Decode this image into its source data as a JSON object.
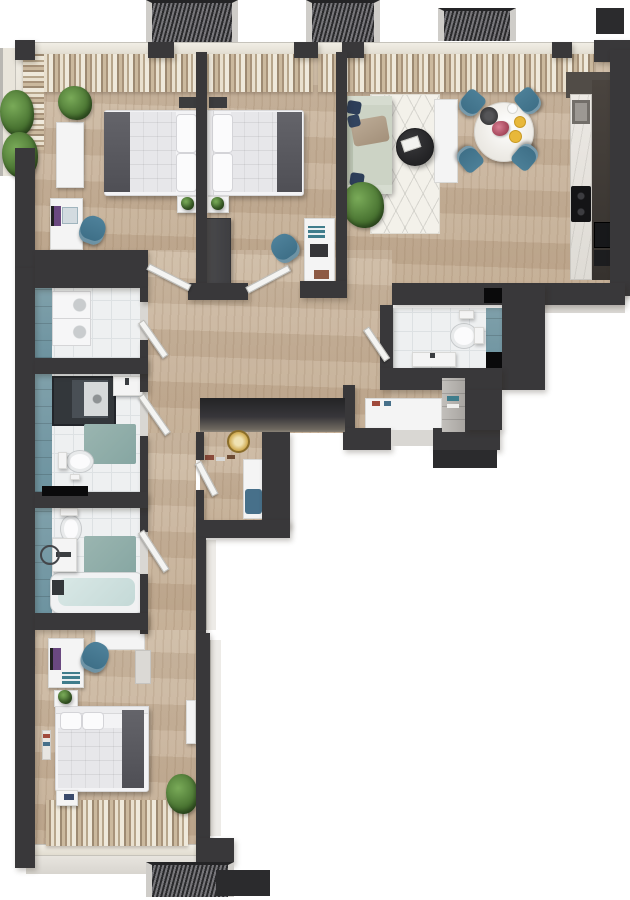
{
  "meta": {
    "label": "3D top-down floor plan render of a three-room apartment, no text labels",
    "view": "top-down 3d render",
    "background": "#ffffff"
  },
  "palette": {
    "wall_dark": "#39383a",
    "wood_floor": "#c9b59c",
    "bath_tile": "#eef0f1",
    "teal_wall_tile": "#7fa0aa",
    "teal_bath_mat": "#93b2ad",
    "curtain_beige": "#cbb99e",
    "chair_teal": "#44758c",
    "sofa_sage": "#ccd4c6",
    "pillow_navy": "#2d3e59",
    "throw_gray": "#5a5a60",
    "mirror_gold": "#cfa94e",
    "plant_green": "#4c7c3a",
    "marble_counter": "#eae8e4",
    "appliance_black": "#141416",
    "tub_water": "#cfe0df",
    "balcony_grate": "#2a2a2c"
  },
  "summary": {
    "bedrooms": 3,
    "bathrooms": 2,
    "guest_wc": 1,
    "balconies_top": 3,
    "balconies_bottom": 1,
    "planted_side_balcony": 1
  },
  "rooms": [
    {
      "name": "bedroom-1",
      "furniture": [
        "double-bed",
        "pillows",
        "gray-throw",
        "dresser",
        "desk",
        "monitor",
        "laptop",
        "office-chair-teal",
        "nightstand-plant",
        "floor-plant"
      ]
    },
    {
      "name": "bedroom-2",
      "furniture": [
        "double-bed",
        "pillows",
        "gray-throw",
        "dark-wardrobe",
        "desk",
        "books",
        "laptop",
        "office-chair-teal",
        "nightstand-plant"
      ]
    },
    {
      "name": "living-room",
      "furniture": [
        "sage-sofa",
        "navy-pillows",
        "tan-throw",
        "geometric-rug",
        "round-coffee-table",
        "magazines",
        "tv-sideboard",
        "round-marble-dining-table",
        "dining-chairs-teal-x4",
        "serving-tray",
        "flower-vase",
        "plates",
        "large-plant"
      ]
    },
    {
      "name": "kitchen",
      "furniture": [
        "marble-counter",
        "sink",
        "cooktop",
        "tall-dark-units",
        "oven",
        "microwave"
      ]
    },
    {
      "name": "laundry-room",
      "furniture": [
        "stacked-washer-dryer"
      ]
    },
    {
      "name": "bathroom-1",
      "furniture": [
        "walk-in-shower",
        "sink",
        "toilet",
        "teal-bath-mat"
      ]
    },
    {
      "name": "bathroom-2",
      "furniture": [
        "bathtub",
        "sink",
        "towel-ring",
        "toilet",
        "teal-bath-mat"
      ]
    },
    {
      "name": "guest-wc",
      "furniture": [
        "toilet",
        "vanity-sink"
      ]
    },
    {
      "name": "hallway-entry",
      "furniture": [
        "built-in-dark-closet",
        "gold-round-mirror",
        "shoes",
        "white-bench-blue-cushion",
        "white-shoe-cabinet",
        "gray-tall-cabinet"
      ]
    },
    {
      "name": "bedroom-3",
      "furniture": [
        "double-bed",
        "pillows",
        "gray-throw",
        "white-wardrobe",
        "desk",
        "monitor",
        "books",
        "office-chair-teal",
        "nightstand-plant",
        "bedside-table",
        "magazine-rack",
        "floor-plant",
        "sideboard"
      ]
    }
  ]
}
